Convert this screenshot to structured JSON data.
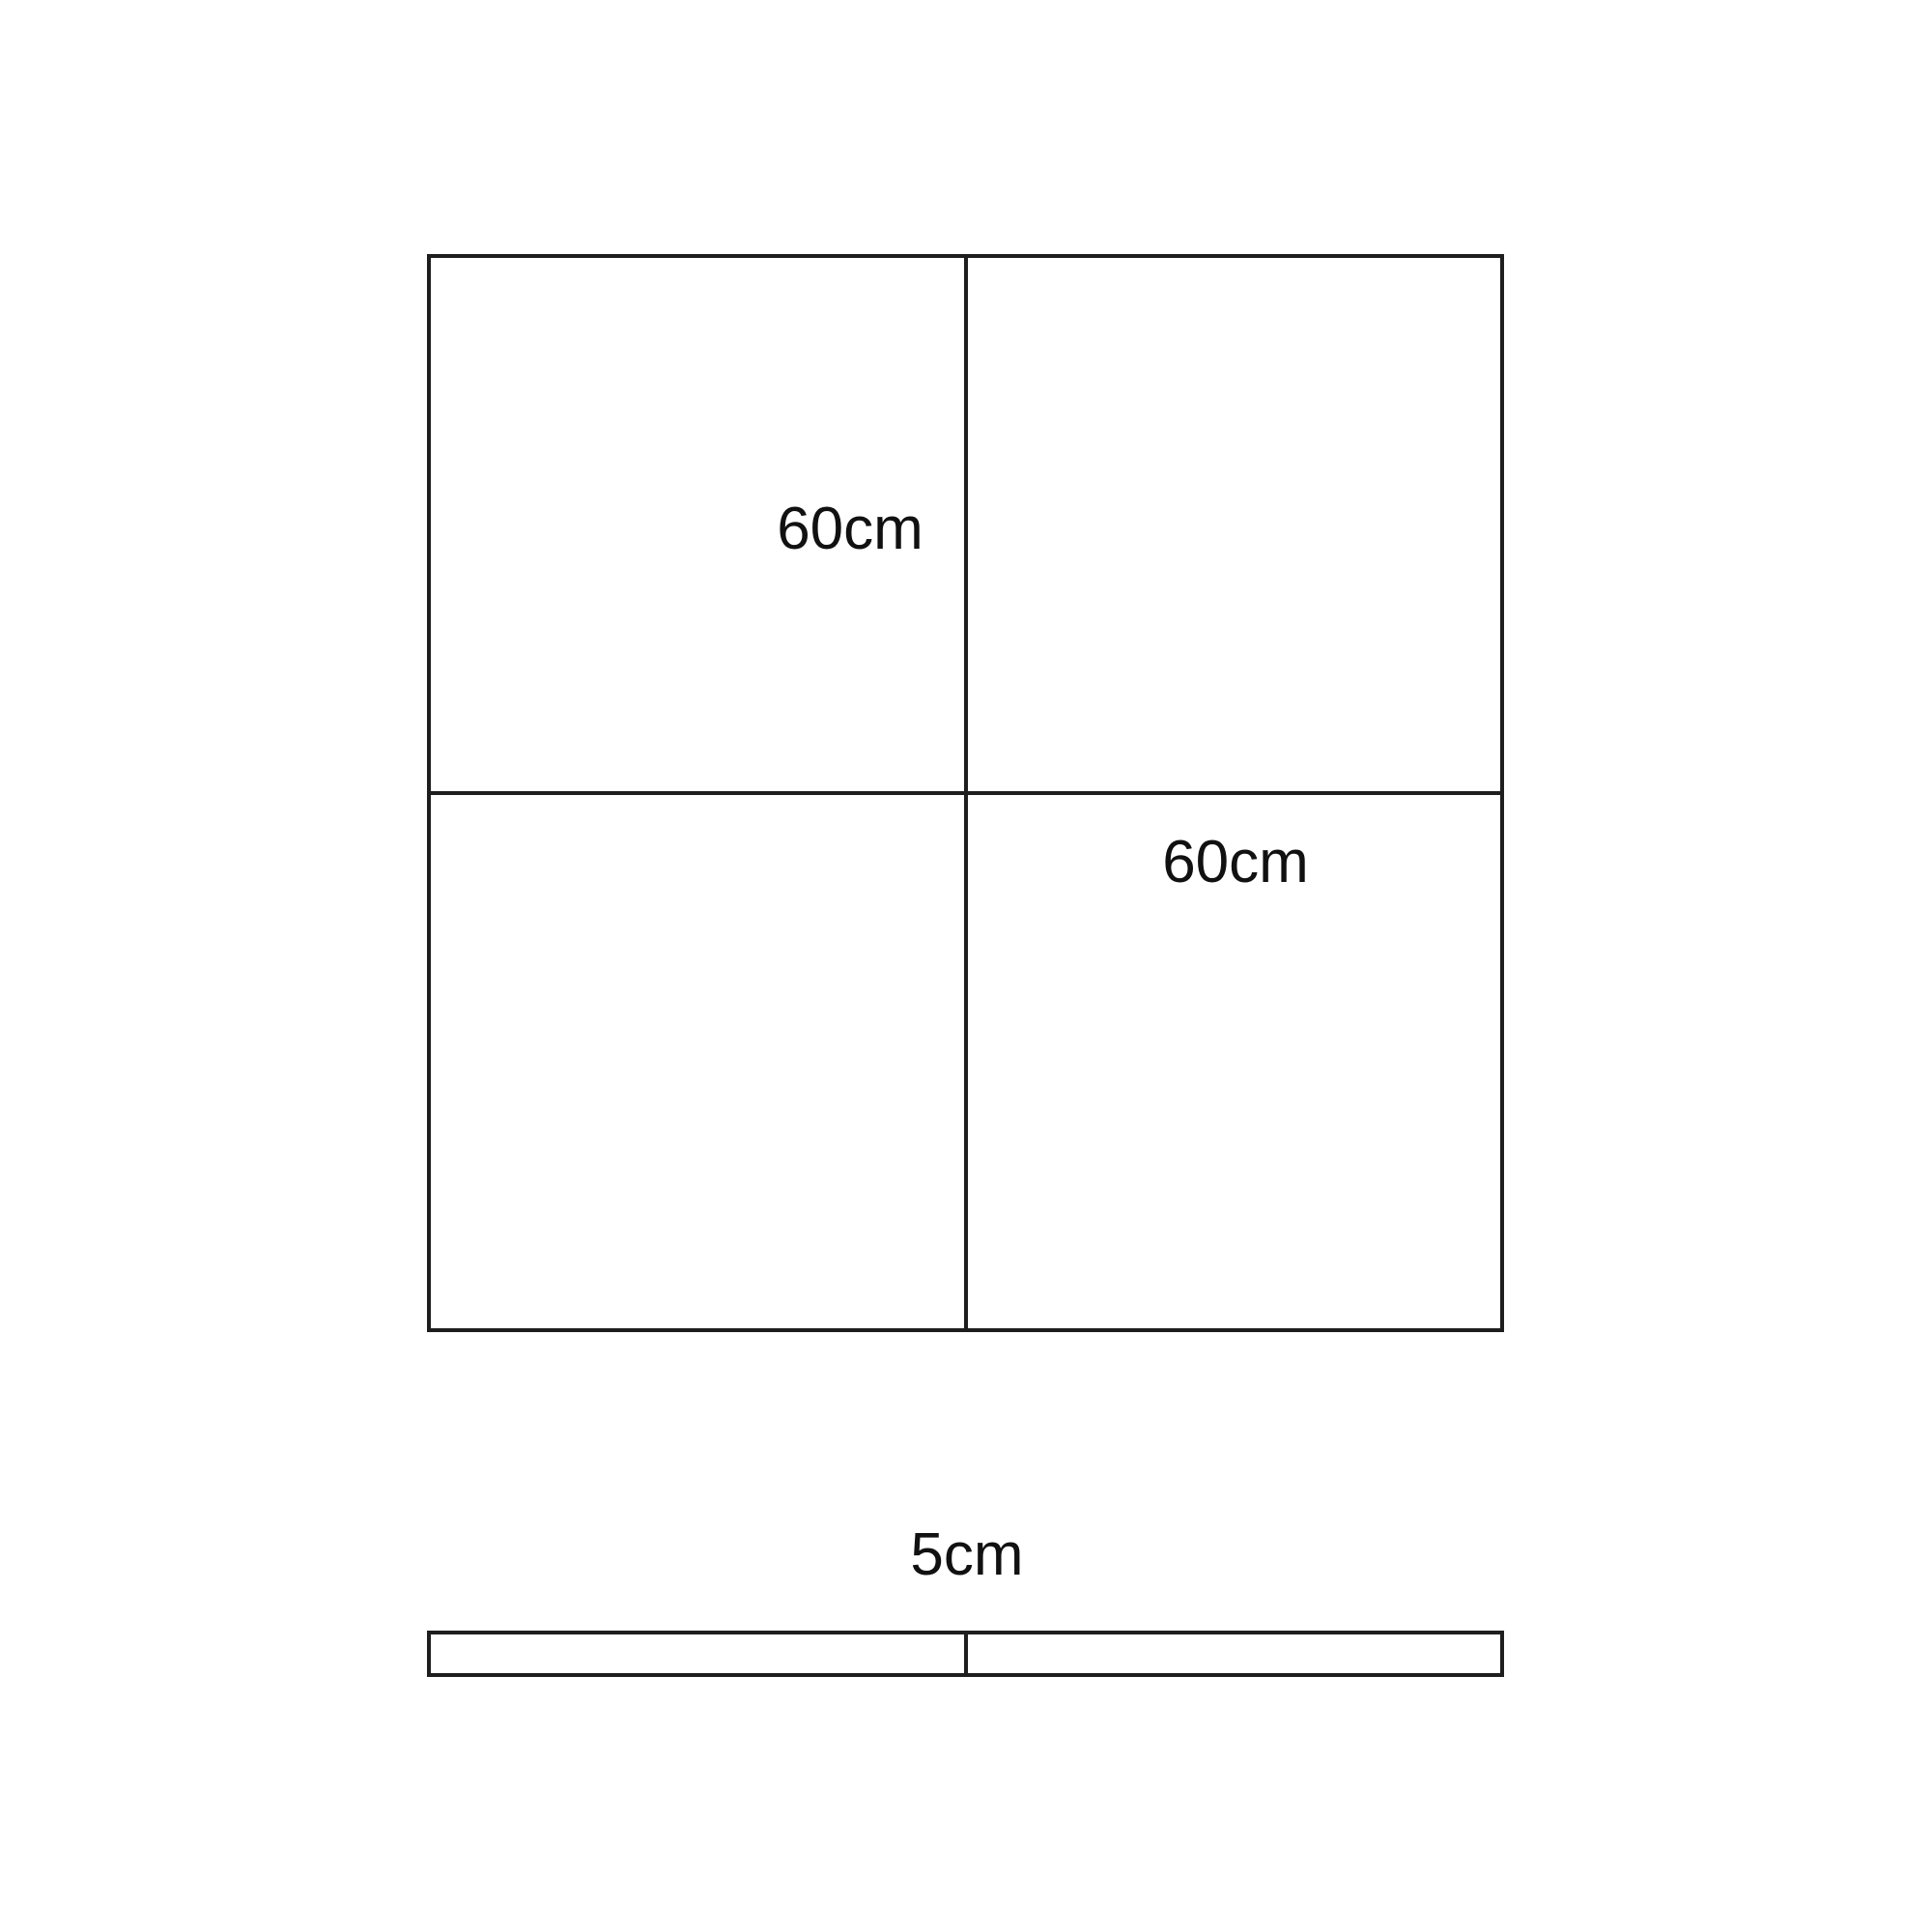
{
  "page": {
    "background": "#ffffff"
  },
  "diagram": {
    "line_color": "#1e1e1e",
    "text_color": "#111111",
    "grid": {
      "label_top_left_quadrant": "60cm",
      "label_bottom_right_quadrant": "60cm"
    },
    "strip": {
      "label": "5cm"
    }
  }
}
